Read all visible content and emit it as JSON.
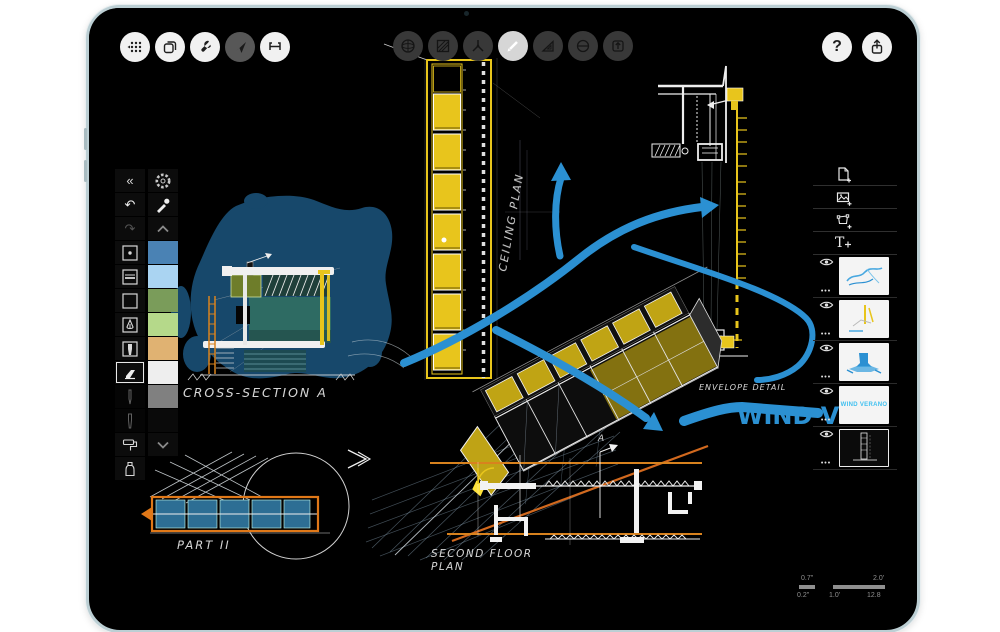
{
  "device": {
    "type": "ipad",
    "frame_color": "#bccfd4"
  },
  "colors": {
    "accent_blue": "#2b90d2",
    "blob_blue": "#17486b",
    "teal_fill": "#2e6b63",
    "olive_fill": "#6e7d2a",
    "yellow": "#e8c51c",
    "orange": "#e07818",
    "screen_bg": "#000000"
  },
  "toolbars": {
    "top_left": {
      "buttons": [
        "apps-grid",
        "pages",
        "tools-wrench",
        "navigate-cursor",
        "measure"
      ],
      "dimmed_button": "navigate-cursor"
    },
    "top_center": {
      "buttons": [
        "sphere",
        "hatch-fill",
        "axes-3d",
        "pen",
        "set-square",
        "protractor",
        "export-stamp"
      ],
      "active_button": "pen"
    },
    "top_right": {
      "help_label": "?",
      "buttons": [
        "help",
        "share"
      ]
    }
  },
  "tool_palette": {
    "collapse_glyph": "«",
    "undo_glyph": "↶",
    "redo_glyph": "↷",
    "tools": [
      "dot-brush",
      "line-weight",
      "blank",
      "pen-nib",
      "marker",
      "eraser",
      "pencil",
      "fine-liner",
      "paint-roller",
      "spray-bottle"
    ],
    "selected_tool": "eraser",
    "swatches": [
      "#4a82b4",
      "#aad4f2",
      "#7a9c5a",
      "#b5d98a",
      "#e0b272",
      "#eeeeee",
      "#808080",
      "#0a0a0a"
    ]
  },
  "layers_panel": {
    "text_tool_glyph": "T",
    "menu_dots": "•••",
    "add_buttons": [
      "add-page",
      "add-image",
      "add-shape",
      "add-text"
    ],
    "layers": [
      {
        "name": "layer-1",
        "thumb": "blue-squiggle"
      },
      {
        "name": "layer-2",
        "thumb": "yellow-sketch"
      },
      {
        "name": "layer-3",
        "thumb": "blue-object"
      },
      {
        "name": "layer-4",
        "thumb": "text",
        "text": "WIND VERANO"
      },
      {
        "name": "layer-5",
        "thumb": "dark-drawing",
        "selected": true
      }
    ]
  },
  "canvas": {
    "labels": {
      "ceiling_plan": "CEILING PLAN",
      "cross_section": "CROSS-SECTION A",
      "part": "PART II",
      "second_floor_line1": "SECOND FLOOR",
      "second_floor_line2": "PLAN",
      "envelope_detail": "ENVELOPE DETAIL",
      "wind_text": "WIND VE",
      "section_marker": "A"
    }
  },
  "scale_bar": {
    "top_left_value": "0.7\"",
    "top_right_value": "2.0'",
    "bottom_left_value": "0.2\"",
    "bottom_mid_value": "1.0'",
    "bottom_right_value": "12.8"
  }
}
